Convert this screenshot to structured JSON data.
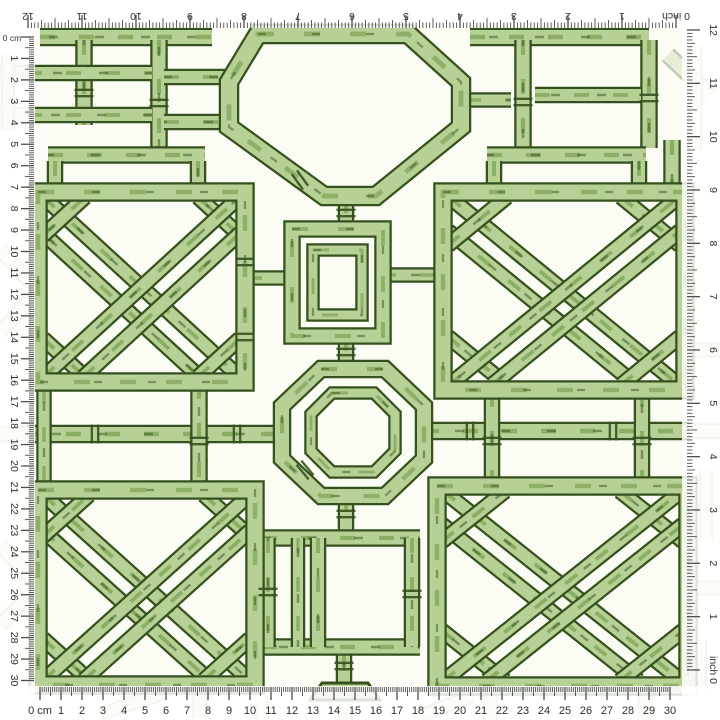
{
  "swatch": {
    "description": "Green bamboo trellis chinoiserie pattern fabric swatch shown with measuring rulers along all four edges",
    "width_inches": 12,
    "width_cm": 30,
    "colors": {
      "background": "#fbfcf3",
      "bamboo_light": "#b7d095",
      "bamboo_mid": "#9cbd72",
      "bamboo_shade": "#7da355",
      "ink_outline": "#35511d",
      "ruler_strip": "#ffffff",
      "tick": "#454545",
      "number": "#2d2d2d"
    }
  },
  "rulers": {
    "top": {
      "unit": "inch",
      "zero_label": "0 inch",
      "orientation": "upside-down",
      "numbers": [
        "0",
        "1",
        "2",
        "3",
        "4",
        "5",
        "6",
        "7",
        "8",
        "9",
        "10",
        "11",
        "12"
      ]
    },
    "right": {
      "unit": "inch",
      "zero_label": "0 inch",
      "orientation": "rotated",
      "numbers": [
        "0",
        "1",
        "2",
        "3",
        "4",
        "5",
        "6",
        "7",
        "8",
        "9",
        "10",
        "11",
        "12"
      ]
    },
    "left": {
      "unit": "cm",
      "zero_label": "0 cm",
      "orientation": "rotated",
      "numbers": [
        "0",
        "1",
        "2",
        "3",
        "4",
        "5",
        "6",
        "7",
        "8",
        "9",
        "10",
        "11",
        "12",
        "13",
        "14",
        "15",
        "16",
        "17",
        "18",
        "19",
        "20",
        "21",
        "22",
        "23",
        "24",
        "25",
        "26",
        "27",
        "28",
        "29",
        "30"
      ]
    },
    "bottom": {
      "unit": "cm",
      "zero_label": "0 cm",
      "orientation": "normal",
      "numbers": [
        "0",
        "1",
        "2",
        "3",
        "4",
        "5",
        "6",
        "7",
        "8",
        "9",
        "10",
        "11",
        "12",
        "13",
        "14",
        "15",
        "16",
        "17",
        "18",
        "19",
        "20",
        "21",
        "22",
        "23",
        "24",
        "25",
        "26",
        "27",
        "28",
        "29",
        "30"
      ]
    }
  }
}
